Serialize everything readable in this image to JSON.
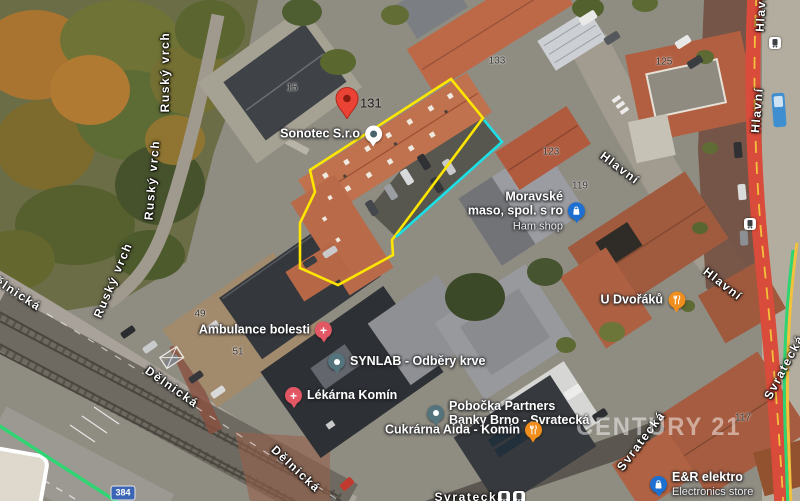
{
  "attribution_watermark": "CENTURY 21",
  "marker": {
    "address_number": "131"
  },
  "road_shield": {
    "number": "384"
  },
  "pois": {
    "sonotec": {
      "name": "Sonotec S.r.o"
    },
    "moravske_maso": {
      "line1": "Moravské",
      "line2": "maso, spol. s ro",
      "subtitle": "Ham shop"
    },
    "ambulance_bolesti": {
      "name": "Ambulance bolesti"
    },
    "synlab": {
      "name": "SYNLAB - Odběry krve"
    },
    "lekarna_komin": {
      "name": "Lékárna Komín"
    },
    "pobocka_partners": {
      "line1": "Pobočka Partners",
      "line2": "Banky Brno - Svratecká"
    },
    "cukrarna_aida": {
      "name": "Cukrárna Aida - Komín"
    },
    "u_dvoraku": {
      "name": "U Dvořáků"
    },
    "er_elektro": {
      "name": "E&R elektro",
      "subtitle": "Electronics store"
    }
  },
  "street_labels": {
    "rusky_vrch_1": "Ruský vrch",
    "rusky_vrch_2": "Ruský vrch",
    "rusky_vrch_3": "Ruský vrch",
    "delnicka_1": "Dělnická",
    "delnicka_2": "Dělnická",
    "delnicka_3": "Dělnická",
    "hlavni_1": "Hlavní",
    "hlavni_2": "Hlavní",
    "hlavni_3": "Hlavní",
    "hlavni_4": "Hlavní",
    "svratecka_1": "Svratecká",
    "svratecka_2": "Svratecká",
    "svratecka_3": "Svratecká"
  },
  "building_numbers": {
    "n15": "15",
    "n49": "49",
    "n51": "51",
    "n117": "117",
    "n119": "119",
    "n123": "123",
    "n125": "125",
    "n133": "133"
  },
  "colors": {
    "parcel_outline_yellow": "#ffe600",
    "parcel_outline_cyan": "#1ce0e6",
    "marker_red": "#ea4335",
    "main_road_red": "#d94b3a",
    "road_centerline_yellow": "#f2c23d",
    "transit_route_green": "#2fd573",
    "poi_red": "#e25764",
    "poi_slate": "#54747d",
    "poi_orange": "#ef8e1d",
    "poi_blue": "#1d70d2",
    "shield_blue": "#3c66b5"
  }
}
